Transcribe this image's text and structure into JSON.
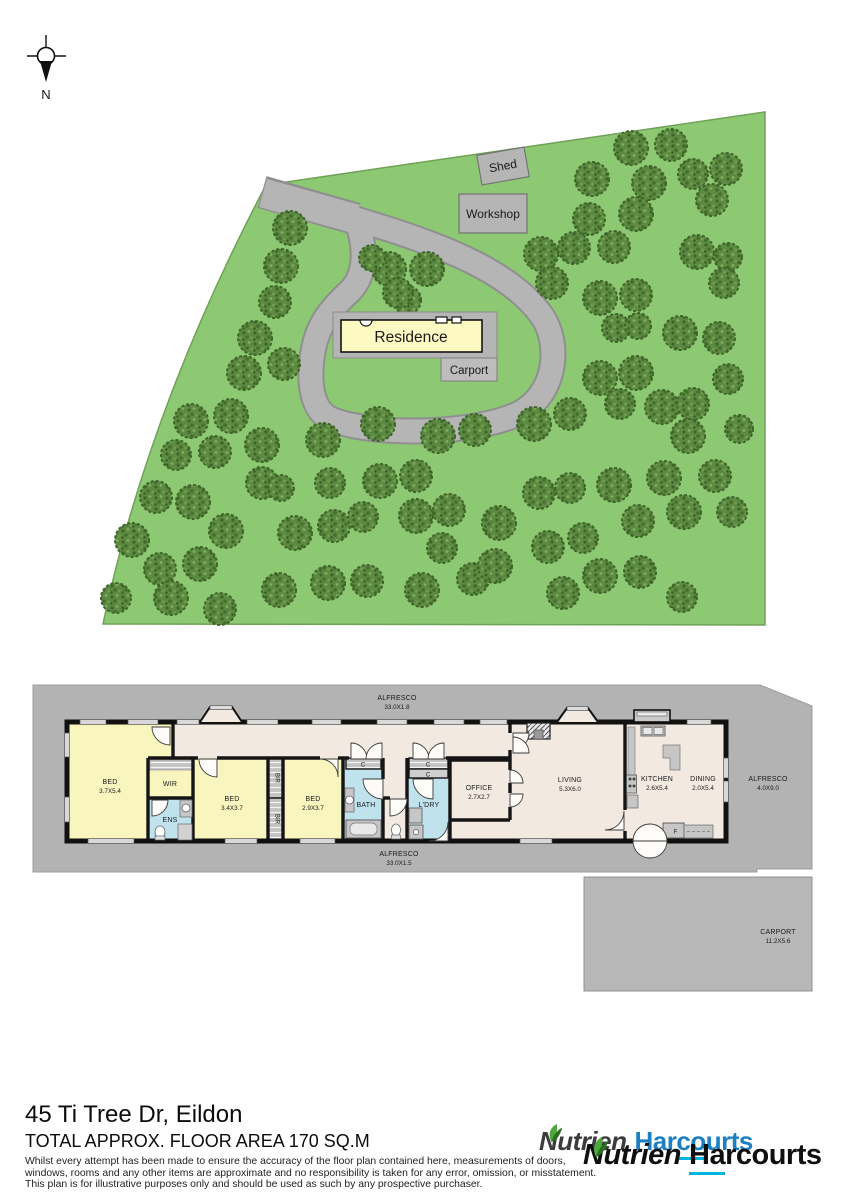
{
  "compass": {
    "north_label": "N"
  },
  "site_plan": {
    "shed_label": "Shed",
    "workshop_label": "Workshop",
    "residence_label": "Residence",
    "carport_label": "Carport",
    "colors": {
      "land": "#8dc973",
      "tree_base": "#5c8a42",
      "driveway": "#b5b5b5",
      "residence_fill": "#fcf9c2",
      "building_gray": "#b5b5b5"
    },
    "trees": [
      [
        290,
        228,
        17
      ],
      [
        281,
        266,
        17
      ],
      [
        275,
        302,
        16
      ],
      [
        255,
        338,
        17
      ],
      [
        244,
        373,
        17
      ],
      [
        284,
        364,
        16
      ],
      [
        389,
        269,
        17
      ],
      [
        427,
        269,
        17
      ],
      [
        407,
        300,
        14
      ],
      [
        372,
        258,
        13
      ],
      [
        398,
        293,
        15
      ],
      [
        378,
        424,
        17
      ],
      [
        438,
        436,
        17
      ],
      [
        475,
        430,
        16
      ],
      [
        534,
        424,
        17
      ],
      [
        570,
        414,
        16
      ],
      [
        631,
        148,
        17
      ],
      [
        671,
        145,
        16
      ],
      [
        592,
        179,
        17
      ],
      [
        649,
        183,
        17
      ],
      [
        693,
        174,
        15
      ],
      [
        726,
        169,
        16
      ],
      [
        589,
        219,
        16
      ],
      [
        636,
        214,
        17
      ],
      [
        712,
        200,
        16
      ],
      [
        541,
        254,
        17
      ],
      [
        574,
        248,
        16
      ],
      [
        614,
        247,
        16
      ],
      [
        697,
        252,
        17
      ],
      [
        728,
        257,
        14
      ],
      [
        552,
        283,
        16
      ],
      [
        600,
        298,
        17
      ],
      [
        636,
        295,
        16
      ],
      [
        724,
        283,
        15
      ],
      [
        680,
        333,
        17
      ],
      [
        719,
        338,
        16
      ],
      [
        616,
        328,
        14
      ],
      [
        638,
        326,
        13
      ],
      [
        600,
        378,
        17
      ],
      [
        636,
        373,
        17
      ],
      [
        620,
        404,
        15
      ],
      [
        662,
        407,
        17
      ],
      [
        693,
        404,
        16
      ],
      [
        728,
        379,
        15
      ],
      [
        739,
        429,
        14
      ],
      [
        688,
        436,
        17
      ],
      [
        191,
        421,
        17
      ],
      [
        231,
        416,
        17
      ],
      [
        176,
        455,
        15
      ],
      [
        215,
        452,
        16
      ],
      [
        262,
        445,
        17
      ],
      [
        323,
        440,
        17
      ],
      [
        380,
        481,
        17
      ],
      [
        416,
        476,
        16
      ],
      [
        330,
        483,
        15
      ],
      [
        262,
        483,
        16
      ],
      [
        281,
        488,
        13
      ],
      [
        156,
        497,
        16
      ],
      [
        193,
        502,
        17
      ],
      [
        226,
        531,
        17
      ],
      [
        295,
        533,
        17
      ],
      [
        334,
        526,
        16
      ],
      [
        363,
        517,
        15
      ],
      [
        416,
        516,
        17
      ],
      [
        449,
        510,
        16
      ],
      [
        499,
        523,
        17
      ],
      [
        539,
        493,
        16
      ],
      [
        570,
        488,
        15
      ],
      [
        614,
        485,
        17
      ],
      [
        664,
        478,
        17
      ],
      [
        715,
        476,
        16
      ],
      [
        732,
        512,
        15
      ],
      [
        684,
        512,
        17
      ],
      [
        638,
        521,
        16
      ],
      [
        583,
        538,
        15
      ],
      [
        548,
        547,
        16
      ],
      [
        132,
        540,
        17
      ],
      [
        160,
        569,
        16
      ],
      [
        200,
        564,
        17
      ],
      [
        116,
        598,
        15
      ],
      [
        171,
        598,
        17
      ],
      [
        220,
        609,
        16
      ],
      [
        279,
        590,
        17
      ],
      [
        328,
        583,
        17
      ],
      [
        367,
        581,
        16
      ],
      [
        422,
        590,
        17
      ],
      [
        473,
        579,
        16
      ],
      [
        442,
        548,
        15
      ],
      [
        495,
        566,
        17
      ],
      [
        600,
        576,
        17
      ],
      [
        640,
        572,
        16
      ],
      [
        682,
        597,
        15
      ],
      [
        563,
        593,
        16
      ]
    ]
  },
  "floor_plan": {
    "alfresco_top": {
      "name": "ALFRESCO",
      "dims": "33.0X1.8"
    },
    "alfresco_bottom": {
      "name": "ALFRESCO",
      "dims": "33.0X1.5"
    },
    "alfresco_right": {
      "name": "ALFRESCO",
      "dims": "4.0X9.0"
    },
    "carport": {
      "name": "CARPORT",
      "dims": "11.2X5.6"
    },
    "bed1": {
      "name": "BED",
      "dims": "3.7X5.4"
    },
    "bed2": {
      "name": "BED",
      "dims": "3.4X3.7"
    },
    "bed3": {
      "name": "BED",
      "dims": "2.9X3.7"
    },
    "wir": "WIR",
    "ens": "ENS",
    "bath": "BATH",
    "ldry": "L'DRY",
    "office": {
      "name": "OFFICE",
      "dims": "2.7X2.7"
    },
    "living": {
      "name": "LIVING",
      "dims": "5.3X6.0"
    },
    "kitchen": {
      "name": "KITCHEN",
      "dims": "2.6X5.4"
    },
    "dining": {
      "name": "DINING",
      "dims": "2.0X5.4"
    },
    "closet": "C",
    "bir": "BIR",
    "fridge": "F"
  },
  "footer": {
    "address": "45 Ti Tree Dr, Eildon",
    "area": "TOTAL APPROX. FLOOR AREA 170 SQ.M",
    "disclaimer": [
      "Whilst every attempt has been made to ensure the accuracy of the floor plan contained here, measurements of doors,",
      "windows, rooms and any other items are approximate and no responsibility is taken for any error, omission, or misstatement.",
      "This plan is for illustrative purposes only and should be used as such by any prospective purchaser."
    ],
    "logo": {
      "brand1": "Nutrien",
      "back_pre": "Har",
      "back_ul": "co",
      "back_post": "urts",
      "front_pre": "Ha",
      "front_post": "rcourts"
    }
  }
}
